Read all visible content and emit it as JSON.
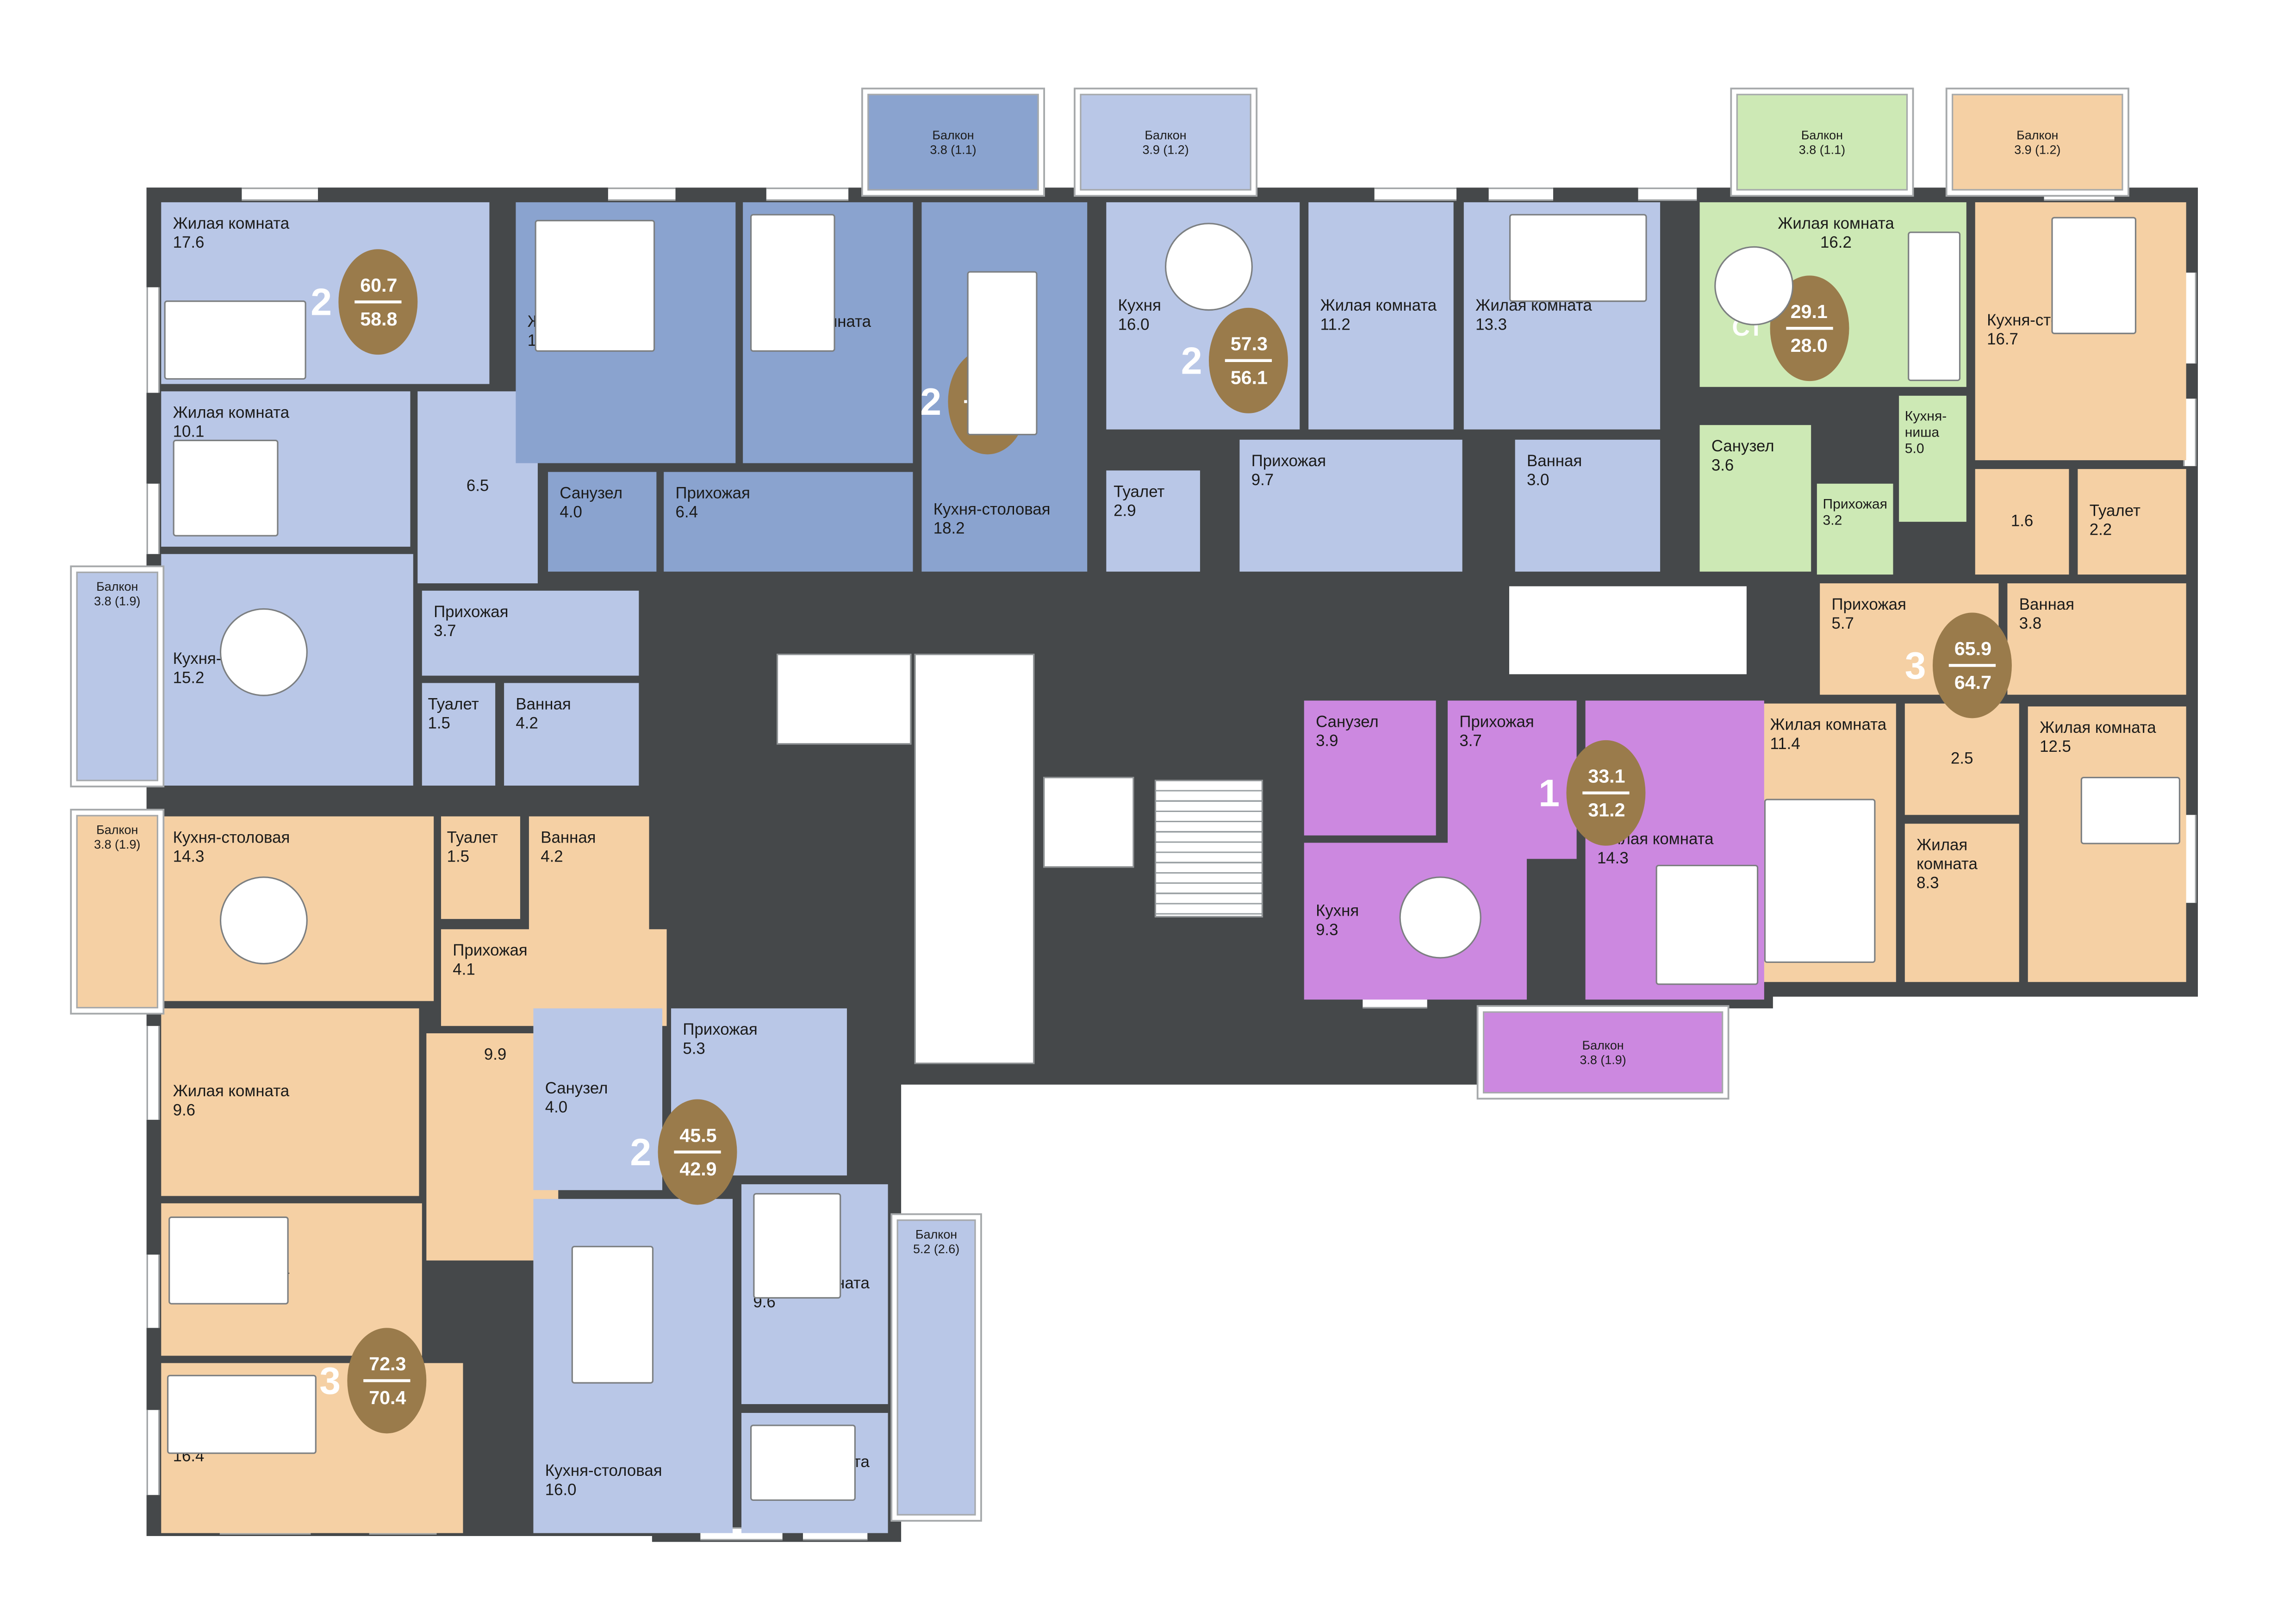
{
  "colors": {
    "wall": "#45484a",
    "badge": "#9a7b4b",
    "apartment_blue_light": "#b9c7e7",
    "apartment_blue_dark": "#8aa3cf",
    "apartment_green": "#cde9b5",
    "apartment_orange": "#f5d0a4",
    "apartment_purple": "#cc88e0"
  },
  "apartments": [
    {
      "type": "2",
      "area_total": "60.7",
      "area_living": "58.8",
      "rooms": [
        {
          "label": "Жилая комната",
          "area": "17.6"
        },
        {
          "label": "Жилая комната",
          "area": "10.1"
        },
        {
          "label": "",
          "area": "6.5"
        },
        {
          "label": "Кухня-столовая",
          "area": "15.2"
        },
        {
          "label": "Прихожая",
          "area": "3.7"
        },
        {
          "label": "Туалет",
          "area": "1.5"
        },
        {
          "label": "Ванная",
          "area": "4.2"
        },
        {
          "label": "Балкон",
          "area": "3.8 (1.9)"
        }
      ]
    },
    {
      "type": "2",
      "area_total": "56.9",
      "area_living": "55.8",
      "rooms": [
        {
          "label": "Жилая комната",
          "area": "15.2"
        },
        {
          "label": "Жилая комната",
          "area": "12.0"
        },
        {
          "label": "Кухня-столовая",
          "area": "18.2"
        },
        {
          "label": "Санузел",
          "area": "4.0"
        },
        {
          "label": "Прихожая",
          "area": "6.4"
        },
        {
          "label": "Балкон",
          "area": "3.8 (1.1)"
        }
      ]
    },
    {
      "type": "2",
      "area_total": "57.3",
      "area_living": "56.1",
      "rooms": [
        {
          "label": "Кухня",
          "area": "16.0"
        },
        {
          "label": "Жилая комната",
          "area": "11.2"
        },
        {
          "label": "Жилая комната",
          "area": "13.3"
        },
        {
          "label": "Туалет",
          "area": "2.9"
        },
        {
          "label": "Прихожая",
          "area": "9.7"
        },
        {
          "label": "Ванная",
          "area": "3.0"
        },
        {
          "label": "Балкон",
          "area": "3.9 (1.2)"
        }
      ]
    },
    {
      "type": "Ст",
      "area_total": "29.1",
      "area_living": "28.0",
      "rooms": [
        {
          "label": "Жилая комната",
          "area": "16.2"
        },
        {
          "label": "Кухня-ниша",
          "area": "5.0"
        },
        {
          "label": "Санузел",
          "area": "3.6"
        },
        {
          "label": "Прихожая",
          "area": "3.2"
        },
        {
          "label": "Балкон",
          "area": "3.8 (1.1)"
        }
      ]
    },
    {
      "type": "3",
      "area_total": "65.9",
      "area_living": "64.7",
      "rooms": [
        {
          "label": "Кухня-столовая",
          "area": "16.7"
        },
        {
          "label": "",
          "area": "1.6"
        },
        {
          "label": "Туалет",
          "area": "2.2"
        },
        {
          "label": "Прихожая",
          "area": "5.7"
        },
        {
          "label": "Ванная",
          "area": "3.8"
        },
        {
          "label": "",
          "area": "2.5"
        },
        {
          "label": "Жилая комната",
          "area": "11.4"
        },
        {
          "label": "Жилая комната",
          "area": "8.3"
        },
        {
          "label": "Жилая комната",
          "area": "12.5"
        },
        {
          "label": "Балкон",
          "area": "3.9 (1.2)"
        }
      ]
    },
    {
      "type": "1",
      "area_total": "33.1",
      "area_living": "31.2",
      "rooms": [
        {
          "label": "Санузел",
          "area": "3.9"
        },
        {
          "label": "Прихожая",
          "area": "3.7"
        },
        {
          "label": "Кухня",
          "area": "9.3"
        },
        {
          "label": "Жилая комната",
          "area": "14.3"
        },
        {
          "label": "Балкон",
          "area": "3.8 (1.9)"
        }
      ]
    },
    {
      "type": "3",
      "area_total": "72.3",
      "area_living": "70.4",
      "rooms": [
        {
          "label": "Кухня-столовая",
          "area": "14.3"
        },
        {
          "label": "Туалет",
          "area": "1.5"
        },
        {
          "label": "Ванная",
          "area": "4.2"
        },
        {
          "label": "Прихожая",
          "area": "4.1"
        },
        {
          "label": "Жилая комната",
          "area": "9.6"
        },
        {
          "label": "",
          "area": "9.9"
        },
        {
          "label": "Жилая комната",
          "area": "10.4"
        },
        {
          "label": "Жилая комната",
          "area": "16.4"
        },
        {
          "label": "Балкон",
          "area": "3.8 (1.9)"
        }
      ]
    },
    {
      "type": "2",
      "area_total": "45.5",
      "area_living": "42.9",
      "rooms": [
        {
          "label": "Санузел",
          "area": "4.0"
        },
        {
          "label": "Прихожая",
          "area": "5.3"
        },
        {
          "label": "Кухня-столовая",
          "area": "16.0"
        },
        {
          "label": "Жилая комната",
          "area": "9.6"
        },
        {
          "label": "Жилая комната",
          "area": "8.0"
        },
        {
          "label": "Балкон",
          "area": "5.2 (2.6)"
        }
      ]
    }
  ]
}
